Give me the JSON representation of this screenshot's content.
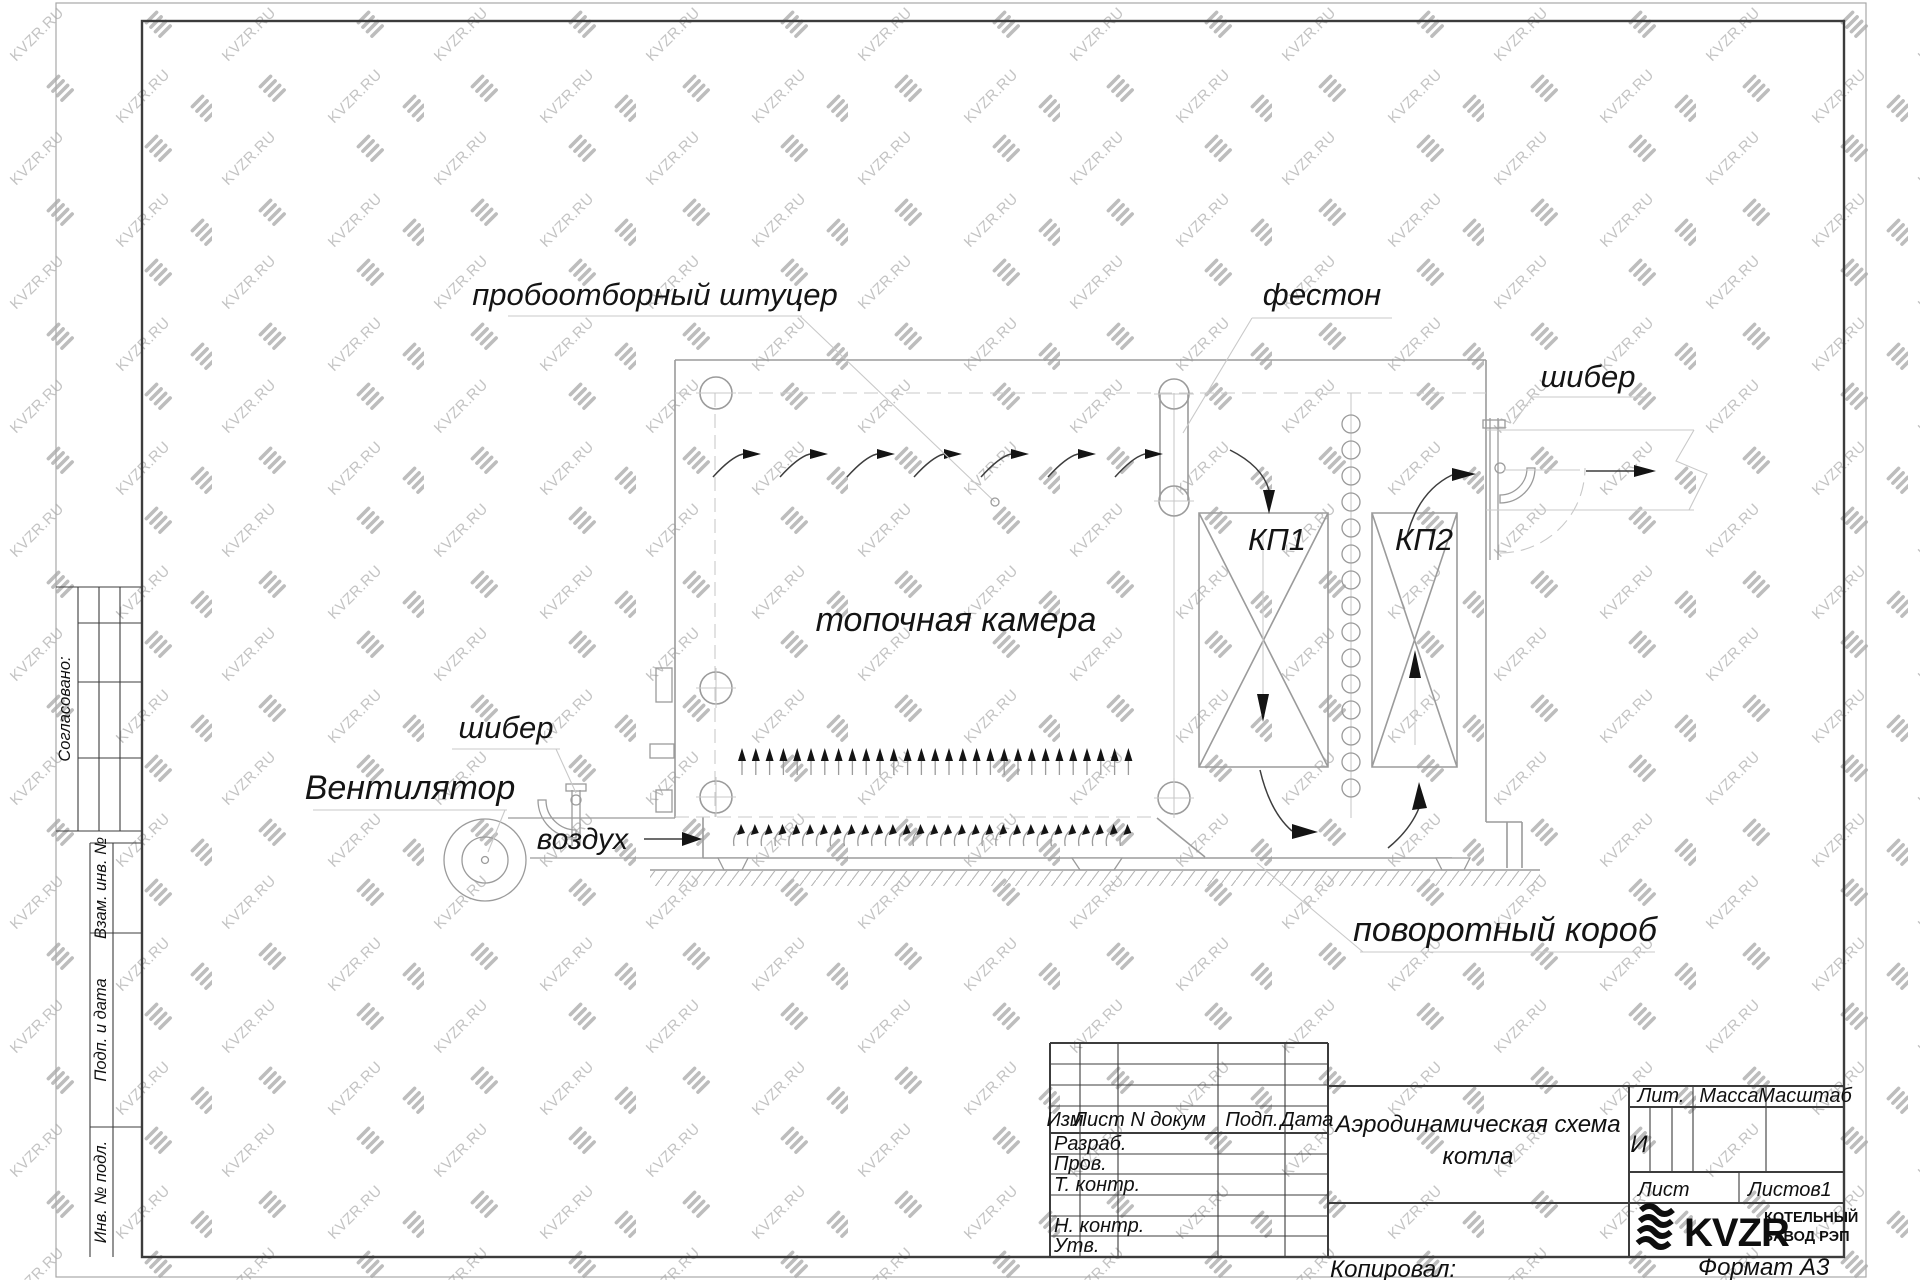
{
  "watermark": {
    "text": "KVZR.RU"
  },
  "drawing": {
    "labels": {
      "sampling": "пробоотборный штуцер",
      "festoon": "фестон",
      "damper": "шибер",
      "fan": "Вентилятор",
      "air": "воздух",
      "furnace": "топочная камера",
      "kp1": "КП1",
      "kp2": "КП2",
      "turning_duct": "поворотный короб"
    }
  },
  "left_stamp": {
    "agreed": "Согласовано:",
    "c1": "Взам. инв. №",
    "c2": "Подп. и дата",
    "c3": "Инв. № подл."
  },
  "title_block": {
    "cols": [
      "Изм",
      "Лист",
      "N докум",
      "Подп.",
      "Дата"
    ],
    "rows": [
      "Разраб.",
      "Пров.",
      "Т. контр.",
      "Н. контр.",
      "Утв."
    ],
    "title_line1": "Аэродинамическая схема",
    "title_line2": "котла",
    "lit": "Лит.",
    "mass": "Масса",
    "scale": "Масштаб",
    "lit_value": "И",
    "sheet": "Лист",
    "sheets": "Листов",
    "sheets_value": "1",
    "brand": "KVZR",
    "brand_line1": "КОТЕЛЬНЫЙ",
    "brand_line2": "ЗАВОД РЭП",
    "copied": "Копировал:",
    "format": "Формат А3"
  }
}
